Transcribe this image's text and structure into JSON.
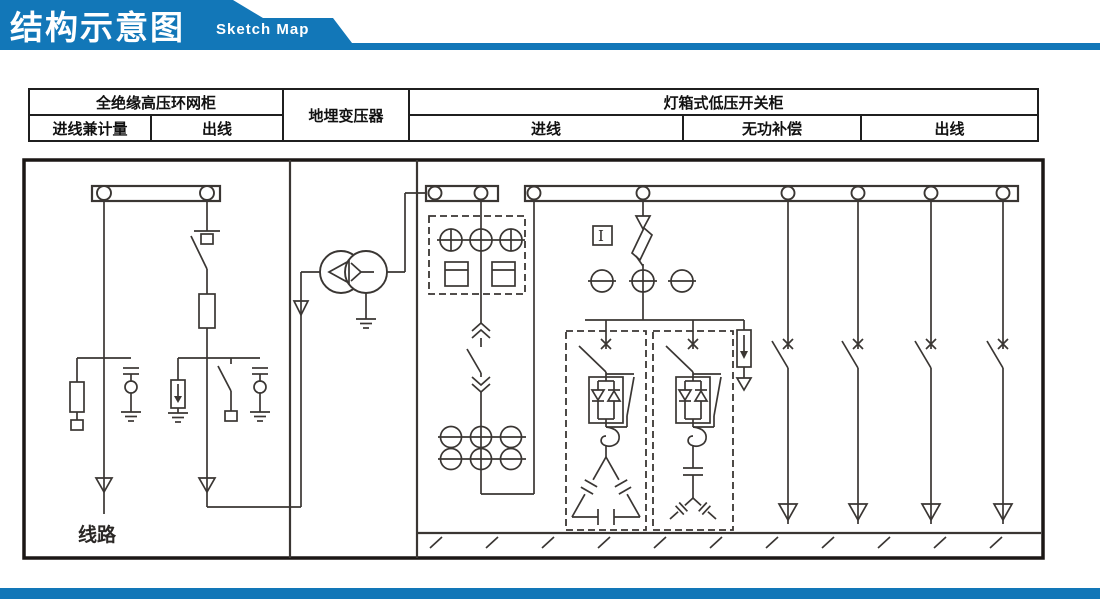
{
  "header": {
    "title": "结构示意图",
    "subtitle": "Sketch Map"
  },
  "colors": {
    "accent": "#1277b8",
    "line": "#3a3633"
  },
  "table": {
    "hv": {
      "title": "全绝缘高压环网柜",
      "col_in": "进线兼计量",
      "col_out": "出线"
    },
    "transformer": {
      "title": "地埋变压器"
    },
    "lv": {
      "title": "灯箱式低压开关柜",
      "col_in": "进线",
      "col_comp": "无功补偿",
      "col_out": "出线"
    }
  },
  "diagram": {
    "line_label": "线路",
    "instrument_marker": "I"
  }
}
